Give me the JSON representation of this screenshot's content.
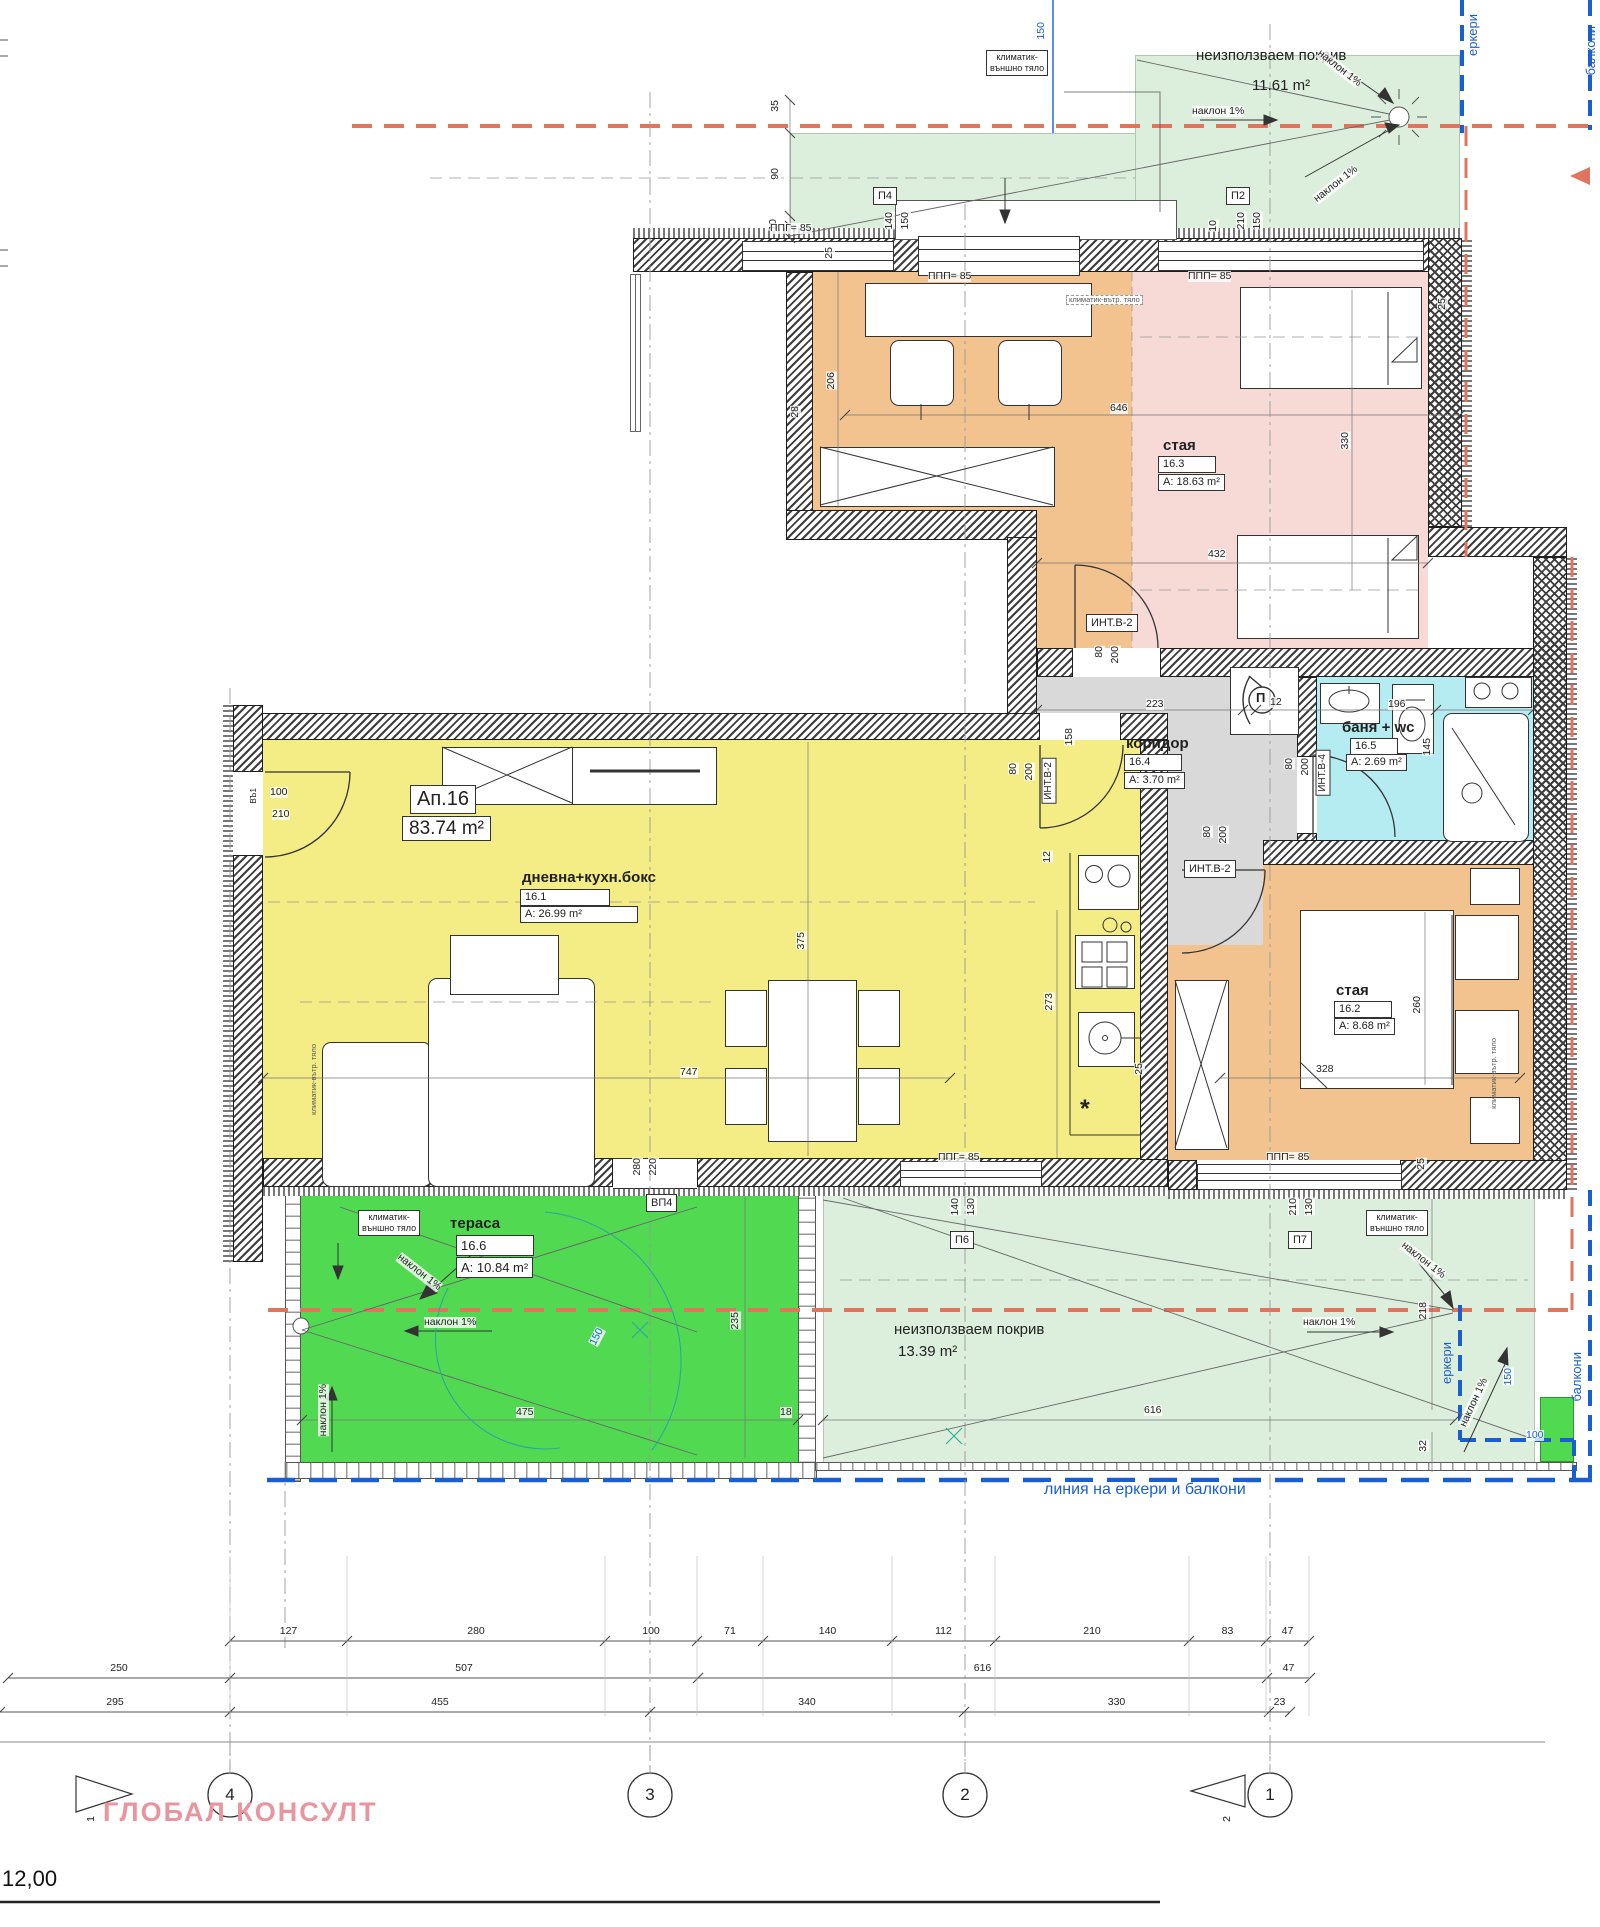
{
  "drawing": {
    "brand": "ГЛОБАЛ КОНСУЛТ",
    "level_mark": "12,00",
    "apartment": {
      "id": "Ап.16",
      "area": "83.74 m²"
    },
    "rooms": [
      {
        "num": "16.1",
        "name": "дневна+кухн.бокс",
        "area": "A: 26.99 m²",
        "fill": "#f4ec85"
      },
      {
        "num": "16.2",
        "name": "стая",
        "area": "A: 8.68 m²",
        "fill": "#f3c38f"
      },
      {
        "num": "16.3",
        "name": "стая",
        "area": "A: 18.63 m²",
        "fill": "#f7d9d6"
      },
      {
        "num": "16.4",
        "name": "коридор",
        "area": "A: 3.70 m²",
        "fill": "#d9d9d9"
      },
      {
        "num": "16.5",
        "name": "баня + wc",
        "area": "A: 2.69 m²",
        "fill": "#b5ecf2"
      },
      {
        "num": "16.6",
        "name": "тераса",
        "area": "A: 10.84 m²",
        "fill": "#52d952"
      }
    ],
    "roofs": [
      {
        "name": "неизползваем покрив",
        "area": "11.61 m²"
      },
      {
        "name": "неизползваем покрив",
        "area": "13.39 m²"
      }
    ],
    "slope_note": "наклон 1%",
    "blue_line_note": "линия на еркери и балкони",
    "edge_notes": [
      "еркери",
      "балкони"
    ],
    "window_codes": [
      "П2",
      "П4",
      "П6",
      "П7",
      "ВП4"
    ],
    "door_codes": [
      "ИНТ.В-2",
      "ИНТ.В-4",
      "ВЪ1"
    ],
    "sill_codes": [
      "ППГ= 85",
      "ППП= 85"
    ],
    "hvac": {
      "outdoor": "климатик-\nвъншно тяло",
      "indoor": "климатик-вътр. тяло"
    },
    "colors": {
      "accent_red": "#e0755f",
      "accent_blue": "#1a5fd0",
      "watermark": "#e8959e"
    }
  },
  "axes": {
    "y": 1795,
    "r": 22,
    "items": [
      {
        "label": "4",
        "x": 230
      },
      {
        "label": "3",
        "x": 650
      },
      {
        "label": "2",
        "x": 965
      },
      {
        "label": "1",
        "x": 1270
      }
    ]
  },
  "dim_rows": [
    {
      "name": "row-upper",
      "y": 1641,
      "ticks": [
        230,
        347,
        605,
        697,
        763,
        892,
        995,
        1189,
        1266,
        1309
      ],
      "labels": [
        "127",
        "280",
        "100",
        "71",
        "140",
        "112",
        "210",
        "83",
        "47"
      ]
    },
    {
      "name": "row-middle",
      "y": 1678,
      "ticks": [
        8,
        230,
        698,
        1267,
        1310
      ],
      "labels": [
        "250",
        "507",
        "616",
        "47"
      ]
    },
    {
      "name": "row-lower",
      "y": 1712,
      "ticks": [
        0,
        230,
        650,
        964,
        1269,
        1290
      ],
      "labels": [
        "295",
        "455",
        "340",
        "330",
        "23"
      ]
    }
  ],
  "annotations": [
    {
      "n": "dim-window-150-top",
      "t": "150",
      "x": 1036,
      "y": 22,
      "c": "dr blue"
    },
    {
      "n": "ac-outdoor-top",
      "t": "климатик-\nвъншно тяло",
      "x": 986,
      "y": 50,
      "c": "box2"
    },
    {
      "n": "roof-top-label",
      "t": "неизползваем покрив",
      "x": 1196,
      "y": 48,
      "c": "rl"
    },
    {
      "n": "roof-top-area",
      "t": "11.61 m²",
      "x": 1252,
      "y": 78,
      "c": "rl"
    },
    {
      "n": "slope-top",
      "t": "наклон 1%",
      "x": 1192,
      "y": 106,
      "c": "d"
    },
    {
      "n": "slope-topright-1",
      "t": "наклон 1%",
      "x": 1322,
      "y": 48,
      "c": "d rot38"
    },
    {
      "n": "slope-topright-2",
      "t": "наклон 1%",
      "x": 1312,
      "y": 196,
      "c": "d rotm38"
    },
    {
      "n": "erker-top",
      "t": "еркери",
      "x": 1466,
      "y": 14,
      "c": "dr blue bigv"
    },
    {
      "n": "balkoni-top",
      "t": "балкони",
      "x": 1584,
      "y": 26,
      "c": "dr blue bigv"
    },
    {
      "n": "dim-35",
      "t": "35",
      "x": 770,
      "y": 100,
      "c": "dr"
    },
    {
      "n": "dim-90",
      "t": "90",
      "x": 770,
      "y": 168,
      "c": "dr"
    },
    {
      "n": "dim-10a",
      "t": "10",
      "x": 768,
      "y": 219,
      "c": "dr"
    },
    {
      "n": "win-code-p4",
      "t": "П4",
      "x": 873,
      "y": 187,
      "c": "box"
    },
    {
      "n": "dim-p4-w",
      "t": "140",
      "x": 884,
      "y": 212,
      "c": "dr"
    },
    {
      "n": "dim-p4-h",
      "t": "150",
      "x": 900,
      "y": 212,
      "c": "dr"
    },
    {
      "n": "win-code-p2",
      "t": "П2",
      "x": 1226,
      "y": 187,
      "c": "box"
    },
    {
      "n": "dim-p2-w",
      "t": "210",
      "x": 1236,
      "y": 212,
      "c": "dr"
    },
    {
      "n": "dim-p2-h",
      "t": "150",
      "x": 1252,
      "y": 212,
      "c": "dr"
    },
    {
      "n": "dim-10b",
      "t": "10",
      "x": 1208,
      "y": 220,
      "c": "dr"
    },
    {
      "n": "sill-ppg-top",
      "t": "ППГ= 85",
      "x": 770,
      "y": 223,
      "c": "d"
    },
    {
      "n": "sill-ppp-1",
      "t": "ППП= 85",
      "x": 928,
      "y": 271,
      "c": "d"
    },
    {
      "n": "sill-ppp-2",
      "t": "ППП= 85",
      "x": 1188,
      "y": 271,
      "c": "d"
    },
    {
      "n": "dim-206",
      "t": "206",
      "x": 826,
      "y": 372,
      "c": "dr"
    },
    {
      "n": "dim-28",
      "t": "28",
      "x": 790,
      "y": 406,
      "c": "dr"
    },
    {
      "n": "dim-25a",
      "t": "25",
      "x": 824,
      "y": 247,
      "c": "dr"
    },
    {
      "n": "dim-646",
      "t": "646",
      "x": 1110,
      "y": 403,
      "c": "d"
    },
    {
      "n": "ac-indoor-163",
      "t": "климатик-вътр. тяло",
      "x": 1066,
      "y": 295,
      "c": "tinybox"
    },
    {
      "n": "room-163-name",
      "t": "стая",
      "x": 1163,
      "y": 438,
      "c": "b"
    },
    {
      "n": "room-163-num",
      "t": "16.3",
      "x": 1158,
      "y": 456,
      "c": "rbox wn"
    },
    {
      "n": "room-163-area",
      "t": "A: 18.63 m²",
      "x": 1158,
      "y": 474,
      "c": "rbox"
    },
    {
      "n": "dim-25b",
      "t": "25",
      "x": 1437,
      "y": 298,
      "c": "dr"
    },
    {
      "n": "dim-330",
      "t": "330",
      "x": 1340,
      "y": 432,
      "c": "dr"
    },
    {
      "n": "dim-432",
      "t": "432",
      "x": 1208,
      "y": 549,
      "c": "d"
    },
    {
      "n": "door-int-b2-a",
      "t": "ИНТ.В-2",
      "x": 1086,
      "y": 614,
      "c": "box"
    },
    {
      "n": "dim-door-a-80",
      "t": "80",
      "x": 1094,
      "y": 646,
      "c": "dr"
    },
    {
      "n": "dim-door-a-200",
      "t": "200",
      "x": 1110,
      "y": 646,
      "c": "dr"
    },
    {
      "n": "room-164-name",
      "t": "коридор",
      "x": 1126,
      "y": 736,
      "c": "b"
    },
    {
      "n": "room-164-num",
      "t": "16.4",
      "x": 1124,
      "y": 754,
      "c": "rbox wn"
    },
    {
      "n": "room-164-area",
      "t": "A: 3.70 m²",
      "x": 1124,
      "y": 772,
      "c": "rbox"
    },
    {
      "n": "dim-223",
      "t": "223",
      "x": 1146,
      "y": 699,
      "c": "d"
    },
    {
      "n": "dim-12a",
      "t": "12",
      "x": 1270,
      "y": 697,
      "c": "d"
    },
    {
      "n": "dim-196",
      "t": "196",
      "x": 1388,
      "y": 699,
      "c": "d"
    },
    {
      "n": "dim-158",
      "t": "158",
      "x": 1064,
      "y": 728,
      "c": "dr"
    },
    {
      "n": "door-int-b2-b",
      "t": "ИНТ.В-2",
      "x": 1042,
      "y": 758,
      "c": "vbox"
    },
    {
      "n": "dim-door-b-80",
      "t": "80",
      "x": 1008,
      "y": 763,
      "c": "dr"
    },
    {
      "n": "dim-door-b-200",
      "t": "200",
      "x": 1024,
      "y": 763,
      "c": "dr"
    },
    {
      "n": "shaft-p-symbol",
      "t": "П",
      "x": 1256,
      "y": 691,
      "c": "psym"
    },
    {
      "n": "room-165-name",
      "t": "баня + wc",
      "x": 1342,
      "y": 720,
      "c": "b"
    },
    {
      "n": "room-165-num",
      "t": "16.5",
      "x": 1350,
      "y": 738,
      "c": "rbox wn2"
    },
    {
      "n": "room-165-area",
      "t": "A: 2.69 m²",
      "x": 1346,
      "y": 754,
      "c": "rbox"
    },
    {
      "n": "dim-145",
      "t": "145",
      "x": 1422,
      "y": 738,
      "c": "dr"
    },
    {
      "n": "door-int-b4",
      "t": "ИНТ.В-4",
      "x": 1316,
      "y": 750,
      "c": "vbox"
    },
    {
      "n": "dim-door-c-80",
      "t": "80",
      "x": 1284,
      "y": 758,
      "c": "dr"
    },
    {
      "n": "dim-door-c-200",
      "t": "200",
      "x": 1300,
      "y": 758,
      "c": "dr"
    },
    {
      "n": "apartment-id",
      "t": "Ап.16",
      "x": 410,
      "y": 785,
      "c": "apb"
    },
    {
      "n": "apartment-area",
      "t": "83.74 m²",
      "x": 402,
      "y": 816,
      "c": "apb2"
    },
    {
      "n": "room-161-name",
      "t": "дневна+кухн.бокс",
      "x": 522,
      "y": 870,
      "c": "b"
    },
    {
      "n": "room-161-num",
      "t": "16.1",
      "x": 520,
      "y": 889,
      "c": "rbox wide85"
    },
    {
      "n": "room-161-area",
      "t": "A: 26.99 m²",
      "x": 520,
      "y": 906,
      "c": "rbox wide115"
    },
    {
      "n": "dim-entry-100",
      "t": "100",
      "x": 270,
      "y": 787,
      "c": "d"
    },
    {
      "n": "dim-entry-210",
      "t": "210",
      "x": 272,
      "y": 809,
      "c": "d"
    },
    {
      "n": "door-entry-code",
      "t": "ВЪ1",
      "x": 250,
      "y": 788,
      "c": "dr tiny"
    },
    {
      "n": "dim-747",
      "t": "747",
      "x": 680,
      "y": 1067,
      "c": "d"
    },
    {
      "n": "dim-375",
      "t": "375",
      "x": 796,
      "y": 932,
      "c": "dr"
    },
    {
      "n": "dim-12b",
      "t": "12",
      "x": 1042,
      "y": 851,
      "c": "dr"
    },
    {
      "n": "dim-273",
      "t": "273",
      "x": 1044,
      "y": 993,
      "c": "dr"
    },
    {
      "n": "kitchen-star",
      "t": "*",
      "x": 1080,
      "y": 1096,
      "c": "star"
    },
    {
      "n": "dim-25c",
      "t": "25",
      "x": 1134,
      "y": 1063,
      "c": "dr"
    },
    {
      "n": "ac-indoor-161",
      "t": "климатик-вътр. тяло",
      "x": 310,
      "y": 1044,
      "c": "drtiny"
    },
    {
      "n": "sill-ppg-bottom",
      "t": "ППГ= 85",
      "x": 938,
      "y": 1152,
      "c": "d"
    },
    {
      "n": "dim-vp4-280",
      "t": "280",
      "x": 632,
      "y": 1158,
      "c": "dr"
    },
    {
      "n": "dim-vp4-220",
      "t": "220",
      "x": 648,
      "y": 1158,
      "c": "dr"
    },
    {
      "n": "door-vp4",
      "t": "ВП4",
      "x": 646,
      "y": 1194,
      "c": "box"
    },
    {
      "n": "door-int-b2-c",
      "t": "ИНТ.В-2",
      "x": 1184,
      "y": 860,
      "c": "box"
    },
    {
      "n": "dim-door-d-80",
      "t": "80",
      "x": 1202,
      "y": 826,
      "c": "dr"
    },
    {
      "n": "dim-door-d-200",
      "t": "200",
      "x": 1218,
      "y": 826,
      "c": "dr"
    },
    {
      "n": "room-162-name",
      "t": "стая",
      "x": 1336,
      "y": 983,
      "c": "b"
    },
    {
      "n": "room-162-num",
      "t": "16.2",
      "x": 1334,
      "y": 1001,
      "c": "rbox wn"
    },
    {
      "n": "room-162-area",
      "t": "A: 8.68 m²",
      "x": 1334,
      "y": 1018,
      "c": "rbox"
    },
    {
      "n": "dim-328",
      "t": "328",
      "x": 1316,
      "y": 1064,
      "c": "d"
    },
    {
      "n": "dim-260",
      "t": "260",
      "x": 1412,
      "y": 996,
      "c": "dr"
    },
    {
      "n": "ac-indoor-162",
      "t": "климатик-вътр. тяло",
      "x": 1490,
      "y": 1038,
      "c": "drtiny"
    },
    {
      "n": "sill-ppp-3",
      "t": "ППП= 85",
      "x": 1266,
      "y": 1152,
      "c": "d"
    },
    {
      "n": "dim-25d",
      "t": "25",
      "x": 1416,
      "y": 1158,
      "c": "dr"
    },
    {
      "n": "ac-outdoor-terrace",
      "t": "климатик-\nвъншно тяло",
      "x": 358,
      "y": 1210,
      "c": "box2"
    },
    {
      "n": "room-166-name",
      "t": "тераса",
      "x": 450,
      "y": 1216,
      "c": "b"
    },
    {
      "n": "room-166-num",
      "t": "16.6",
      "x": 456,
      "y": 1235,
      "c": "rbox big wide75"
    },
    {
      "n": "room-166-area",
      "t": "A: 10.84 m²",
      "x": 456,
      "y": 1257,
      "c": "rbox big"
    },
    {
      "n": "slope-terrace-diag",
      "t": "наклон 1%",
      "x": 402,
      "y": 1252,
      "c": "d rot38"
    },
    {
      "n": "slope-terrace-h",
      "t": "наклон 1%",
      "x": 424,
      "y": 1317,
      "c": "d"
    },
    {
      "n": "slope-terrace-v",
      "t": "наклон 1%",
      "x": 318,
      "y": 1384,
      "c": "dr"
    },
    {
      "n": "dim-475",
      "t": "475",
      "x": 516,
      "y": 1407,
      "c": "d"
    },
    {
      "n": "dim-150-blue-terr",
      "t": "150",
      "x": 588,
      "y": 1342,
      "c": "d blue rotm62"
    },
    {
      "n": "dim-235",
      "t": "235",
      "x": 730,
      "y": 1312,
      "c": "dr"
    },
    {
      "n": "dim-18",
      "t": "18",
      "x": 780,
      "y": 1407,
      "c": "d"
    },
    {
      "n": "roof-low-label",
      "t": "неизползваем покрив",
      "x": 894,
      "y": 1322,
      "c": "rl"
    },
    {
      "n": "roof-low-area",
      "t": "13.39 m²",
      "x": 898,
      "y": 1344,
      "c": "rl"
    },
    {
      "n": "win-code-p6",
      "t": "П6",
      "x": 950,
      "y": 1231,
      "c": "box"
    },
    {
      "n": "dim-p6-w",
      "t": "140",
      "x": 950,
      "y": 1198,
      "c": "dr"
    },
    {
      "n": "dim-p6-h",
      "t": "130",
      "x": 966,
      "y": 1198,
      "c": "dr"
    },
    {
      "n": "win-code-p7",
      "t": "П7",
      "x": 1288,
      "y": 1231,
      "c": "box"
    },
    {
      "n": "dim-p7-w",
      "t": "210",
      "x": 1288,
      "y": 1198,
      "c": "dr"
    },
    {
      "n": "dim-p7-h",
      "t": "130",
      "x": 1304,
      "y": 1198,
      "c": "dr"
    },
    {
      "n": "ac-outdoor-roof",
      "t": "климатик-\nвъншно тяло",
      "x": 1366,
      "y": 1210,
      "c": "box2"
    },
    {
      "n": "slope-roof-h",
      "t": "наклон 1%",
      "x": 1303,
      "y": 1317,
      "c": "d"
    },
    {
      "n": "slope-roof-diag1",
      "t": "наклон 1%",
      "x": 1406,
      "y": 1240,
      "c": "d rot38"
    },
    {
      "n": "slope-roof-diag2",
      "t": "наклон 1%",
      "x": 1458,
      "y": 1424,
      "c": "d rotm65"
    },
    {
      "n": "dim-616",
      "t": "616",
      "x": 1144,
      "y": 1405,
      "c": "d"
    },
    {
      "n": "dim-218",
      "t": "218",
      "x": 1418,
      "y": 1302,
      "c": "dr"
    },
    {
      "n": "dim-32",
      "t": "32",
      "x": 1418,
      "y": 1440,
      "c": "dr"
    },
    {
      "n": "dim-150-blue-right",
      "t": "150",
      "x": 1503,
      "y": 1368,
      "c": "dr blue"
    },
    {
      "n": "dim-100-blue",
      "t": "100",
      "x": 1526,
      "y": 1430,
      "c": "d blue"
    },
    {
      "n": "erker-bottom",
      "t": "еркери",
      "x": 1440,
      "y": 1342,
      "c": "dr blue bigv"
    },
    {
      "n": "balkoni-bottom",
      "t": "балкони",
      "x": 1570,
      "y": 1352,
      "c": "dr blue bigv"
    },
    {
      "n": "blue-line-note",
      "t": "линия на еркери и балкони",
      "x": 1044,
      "y": 1482,
      "c": "bluetext"
    },
    {
      "n": "section-marker-1-label",
      "t": "1",
      "x": 86,
      "y": 1816,
      "c": "dr"
    },
    {
      "n": "section-marker-2-label",
      "t": "2",
      "x": 1222,
      "y": 1816,
      "c": "dr"
    }
  ]
}
